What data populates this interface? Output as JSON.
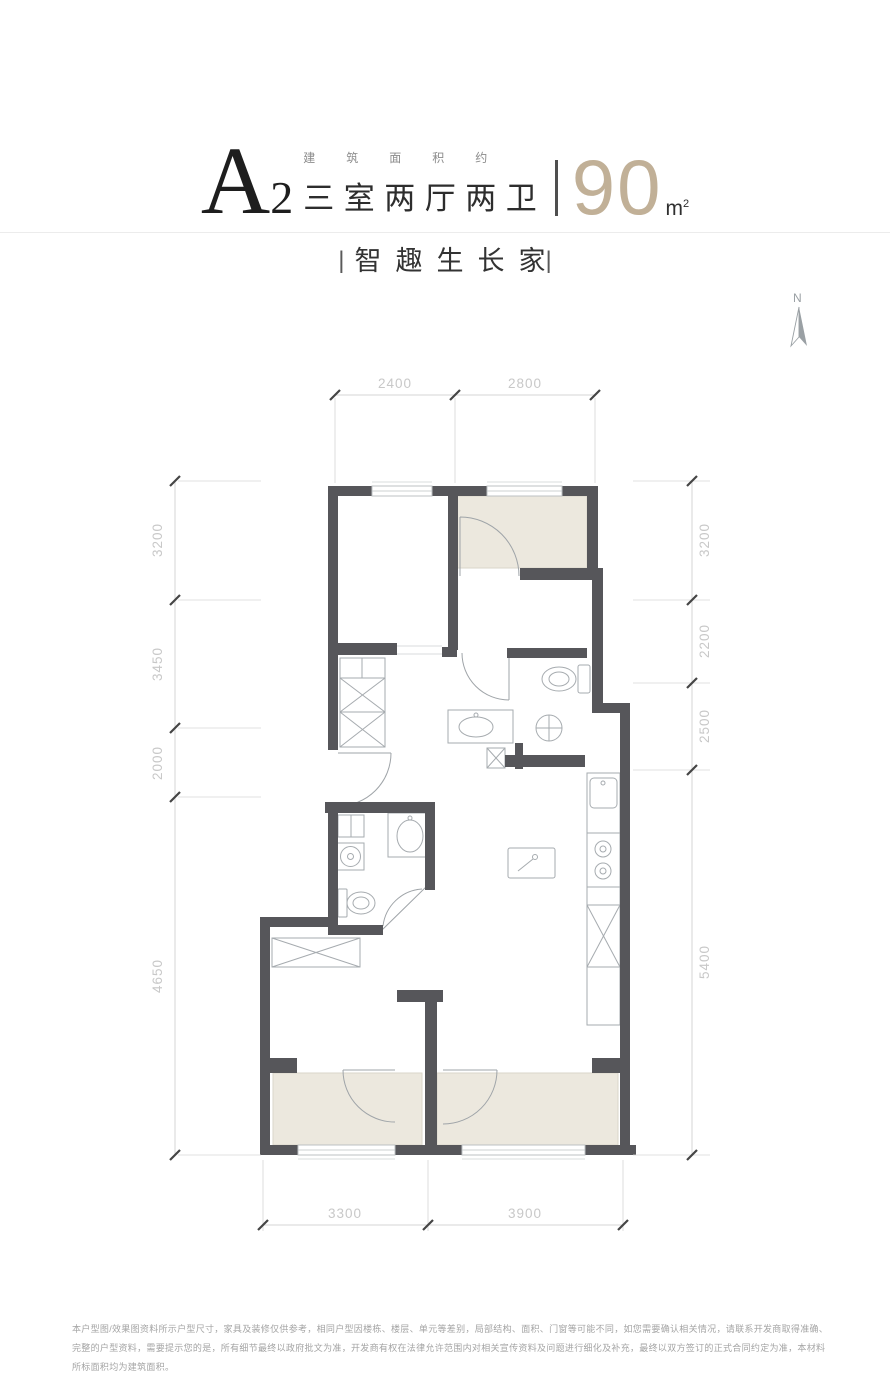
{
  "theme": {
    "wall": "#56565A",
    "room_fill": "#ECE8DE",
    "accent": "#C1B097",
    "line": "#A6ABAF",
    "line_light": "#CDD0D2",
    "dim_line": "#D6D6D6",
    "dim_text": "#C8C8C8",
    "tick": "#454545"
  },
  "header": {
    "unit_code_main": "A",
    "unit_code_sub": "2",
    "area_label": "建筑面积约",
    "layout_title": "三室两厅两卫",
    "area_value": "90",
    "area_unit": "m",
    "area_unit_sup": "2"
  },
  "slogan": {
    "bar": "|",
    "text": "智趣生长家"
  },
  "compass": {
    "label": "N"
  },
  "floorplan": {
    "dimensions": {
      "top": [
        "2400",
        "2800"
      ],
      "left": [
        "3200",
        "3450",
        "2000",
        "4650"
      ],
      "right": [
        "3200",
        "2200",
        "2500",
        "5400"
      ],
      "bottom": [
        "3300",
        "3900"
      ]
    }
  },
  "disclaimer": "本户型图/效果图资料所示户型尺寸，家具及装修仅供参考，相同户型因楼栋、楼层、单元等差别，局部结构、面积、门窗等可能不同，如您需要确认相关情况，请联系开发商取得准确、完整的户型资料，需要提示您的是，所有细节最终以政府批文为准，开发商有权在法律允许范围内对相关宣传资料及问题进行细化及补充，最终以双方签订的正式合同约定为准，本材料所标面积均为建筑面积。"
}
